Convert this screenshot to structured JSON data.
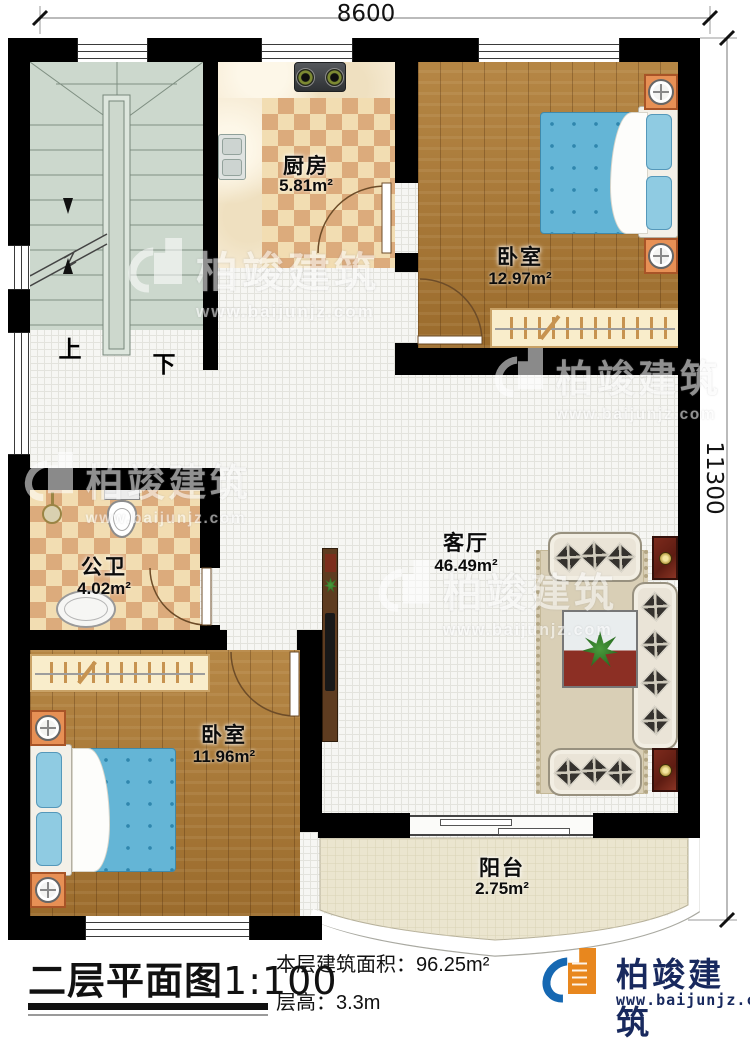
{
  "plan": {
    "dimensions": {
      "top": "8600",
      "right": "11300"
    },
    "rooms": [
      {
        "id": "kitchen",
        "name": "厨房",
        "area": "5.81m²"
      },
      {
        "id": "bedroom-top",
        "name": "卧室",
        "area": "12.97m²"
      },
      {
        "id": "living-room",
        "name": "客厅",
        "area": "46.49m²"
      },
      {
        "id": "bathroom",
        "name": "公卫",
        "area": "4.02m²"
      },
      {
        "id": "bedroom-bottom",
        "name": "卧室",
        "area": "11.96m²"
      },
      {
        "id": "balcony",
        "name": "阳台",
        "area": "2.75m²"
      }
    ],
    "stairs": {
      "up_label": "上",
      "down_label": "下"
    }
  },
  "title_block": {
    "title": "二层平面图",
    "scale": "1:100",
    "floor_area": "本层建筑面积：96.25m²",
    "floor_height": "层高：3.3m"
  },
  "brand": {
    "name": "柏竣建筑",
    "website": "www.baijunjz.com"
  },
  "watermark": {
    "name": "柏竣建筑",
    "website": "www.baijunjz.com"
  },
  "colors": {
    "wall": "#000000",
    "wood": "#ab7934",
    "tile": "#f6f6f3",
    "checker-a": "#f2ddb2",
    "checker-b": "#dcab7c",
    "sage": "#ccd8cd",
    "balcony": "#ebe5cf",
    "bed-blue": "#64b5d6",
    "nstand-orange": "#e79055",
    "brand-blue": "#1668b2",
    "brand-orange": "#e8871e",
    "brand-navy": "#18295e"
  }
}
